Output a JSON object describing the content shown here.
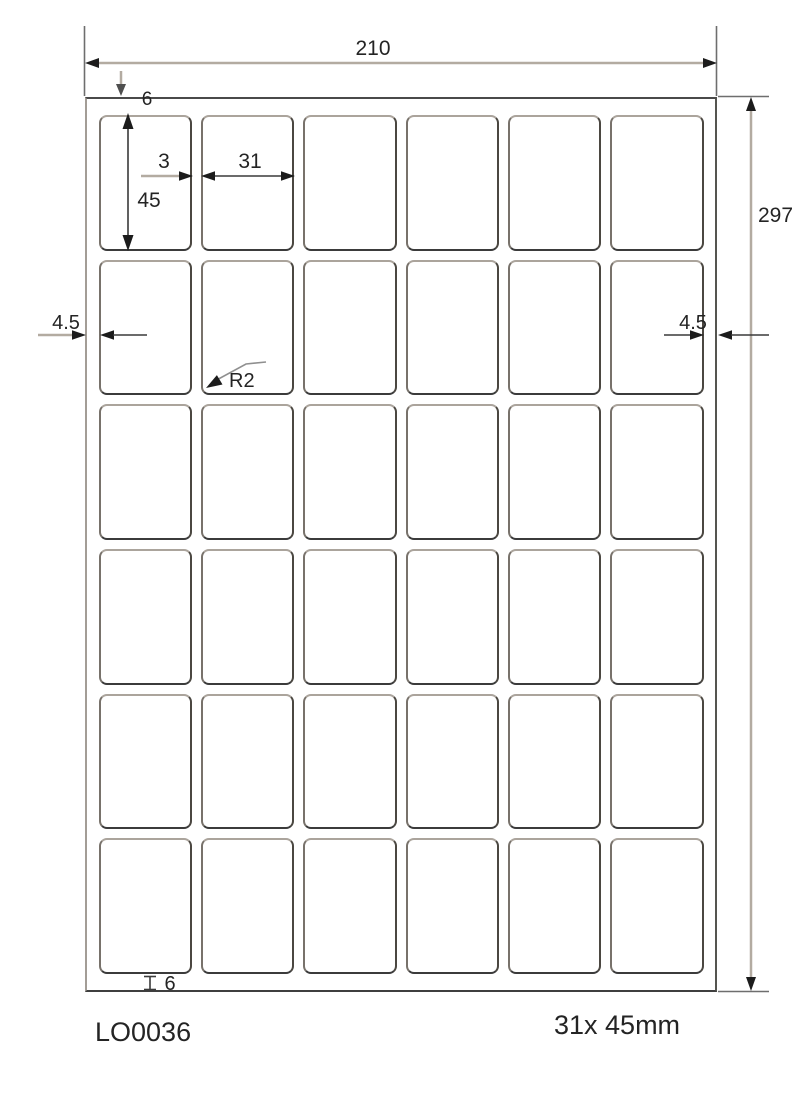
{
  "diagram": {
    "code": "LO0036",
    "size_label": "31x 45mm",
    "grid": {
      "rows": 6,
      "cols": 6
    },
    "dims": {
      "sheet_width": "210",
      "sheet_height": "297",
      "margin_top": "6",
      "margin_bottom": "6",
      "margin_left": "4.5",
      "margin_right": "4.5",
      "label_width": "31",
      "label_height": "45",
      "gap_horizontal": "3",
      "corner_radius": "R2"
    },
    "colors": {
      "shaft_gray": "#b3aba1",
      "line_dark": "#3a3a3a",
      "arrow": "#1c1c1c",
      "text": "#242424"
    }
  }
}
